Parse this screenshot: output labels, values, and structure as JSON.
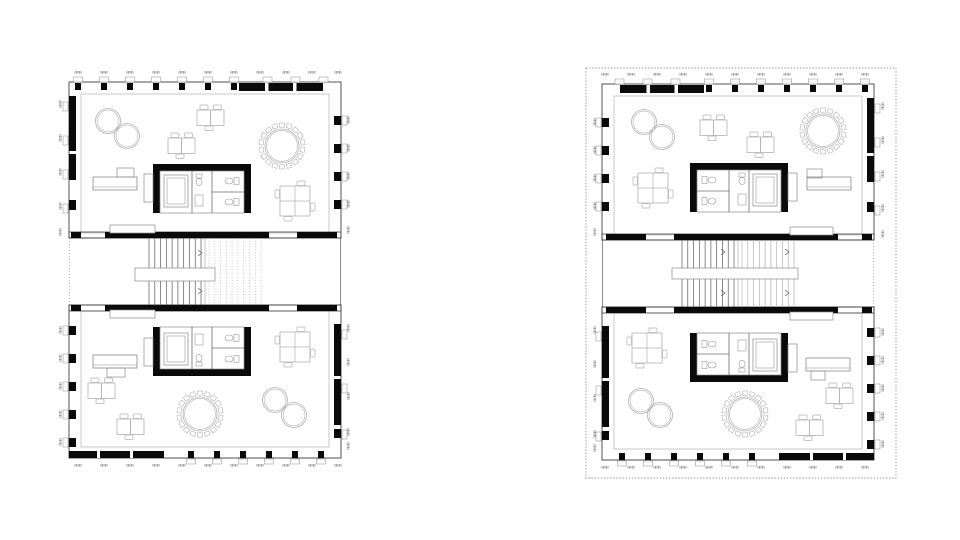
{
  "document": {
    "kind": "architectural-floor-plan-sheet",
    "background": "#ffffff",
    "plans_count": 2
  },
  "colors": {
    "wall": "#0a0a0a",
    "frame": "#3f3f3f",
    "mid": "#8a8a8a",
    "light": "#b2b2b2",
    "faint": "#c9c9c9",
    "tread": "#5a5a5a",
    "white": "#ffffff"
  },
  "plans": [
    {
      "id": "floor-plan-left",
      "origin": [
        69,
        80
      ],
      "mirrored": false,
      "dotted_boundary": null,
      "stair": {
        "landing": [
          66,
          188,
          80,
          13
        ],
        "flight2_dotted": true,
        "arrows": [
          [
            131,
            173
          ],
          [
            131,
            211
          ]
        ]
      },
      "furniture": [
        {
          "floor": "upper",
          "type": "fig8",
          "c1": [
            39,
            41
          ],
          "c2": [
            58,
            56
          ],
          "r": 12.5
        },
        {
          "floor": "upper",
          "type": "deskpair",
          "x": 128,
          "y": 30
        },
        {
          "floor": "upper",
          "type": "deskpair",
          "x": 99,
          "y": 58
        },
        {
          "floor": "upper",
          "type": "roundtable",
          "c": [
            213,
            66
          ]
        },
        {
          "floor": "upper",
          "type": "reception",
          "main": [
            24,
            97
          ],
          "small": [
            48,
            88,
            17,
            9
          ]
        },
        {
          "floor": "upper",
          "type": "quadtable",
          "x": 211,
          "y": 106
        },
        {
          "floor": "upper",
          "type": "core",
          "x": 84,
          "y": 84,
          "orient": "top",
          "attach": "left"
        },
        {
          "floor": "upper",
          "type": "opening",
          "rect": [
            41,
            145,
            45,
            8
          ]
        },
        {
          "floor": "lower",
          "type": "opening",
          "rect": [
            41,
            230,
            45,
            8
          ]
        },
        {
          "floor": "lower",
          "type": "quadtable",
          "x": 211,
          "y": 252
        },
        {
          "floor": "lower",
          "type": "reception",
          "main": [
            24,
            275
          ],
          "small": [
            38,
            288,
            18,
            9
          ]
        },
        {
          "floor": "lower",
          "type": "core",
          "x": 84,
          "y": 247,
          "orient": "bottom",
          "attach": "left"
        },
        {
          "floor": "lower",
          "type": "fig8",
          "c1": [
            206,
            320
          ],
          "c2": [
            225,
            335
          ],
          "r": 12.5
        },
        {
          "floor": "lower",
          "type": "roundtable",
          "c": [
            131,
            334
          ]
        },
        {
          "floor": "lower",
          "type": "deskpair",
          "x": 19,
          "y": 303
        },
        {
          "floor": "lower",
          "type": "deskpair",
          "x": 48,
          "y": 339
        }
      ]
    },
    {
      "id": "floor-plan-right",
      "origin": [
        602,
        82
      ],
      "mirrored": true,
      "dotted_boundary": [
        -16,
        -14,
        310,
        410
      ],
      "stair": {
        "landing": [
          70,
          186,
          126,
          11
        ],
        "flight2_dotted": false,
        "arrows": [
          [
            121,
            170
          ],
          [
            185,
            170
          ],
          [
            121,
            211
          ],
          [
            185,
            211
          ]
        ]
      },
      "furniture": [
        {
          "floor": "upper",
          "type": "fig8",
          "c1": [
            42,
            40
          ],
          "c2": [
            60,
            55
          ],
          "r": 12.5
        },
        {
          "floor": "upper",
          "type": "deskpair",
          "x": 98,
          "y": 38
        },
        {
          "floor": "upper",
          "type": "deskpair",
          "x": 145,
          "y": 55
        },
        {
          "floor": "upper",
          "type": "roundtable",
          "c": [
            221,
            49
          ]
        },
        {
          "floor": "upper",
          "type": "quadtable",
          "x": 36,
          "y": 91
        },
        {
          "floor": "upper",
          "type": "reception",
          "main": [
            205,
            95
          ],
          "small": [
            205,
            87,
            15,
            9
          ]
        },
        {
          "floor": "upper",
          "type": "core",
          "x": 88,
          "y": 81,
          "orient": "top",
          "attach": "right"
        },
        {
          "floor": "upper",
          "type": "opening",
          "rect": [
            188,
            145,
            43,
            8
          ]
        },
        {
          "floor": "lower",
          "type": "opening",
          "rect": [
            188,
            230,
            43,
            8
          ]
        },
        {
          "floor": "lower",
          "type": "quadtable",
          "x": 30,
          "y": 251
        },
        {
          "floor": "lower",
          "type": "core",
          "x": 88,
          "y": 251,
          "orient": "bottom",
          "attach": "right"
        },
        {
          "floor": "lower",
          "type": "reception",
          "main": [
            204,
            276
          ],
          "small": [
            209,
            289,
            14,
            9
          ]
        },
        {
          "floor": "lower",
          "type": "fig8",
          "c1": [
            39,
            319
          ],
          "c2": [
            58,
            333
          ],
          "r": 12.5
        },
        {
          "floor": "lower",
          "type": "roundtable",
          "c": [
            143,
            332
          ]
        },
        {
          "floor": "lower",
          "type": "deskpair",
          "x": 224,
          "y": 306
        },
        {
          "floor": "lower",
          "type": "deskpair",
          "x": 194,
          "y": 338
        }
      ]
    }
  ]
}
